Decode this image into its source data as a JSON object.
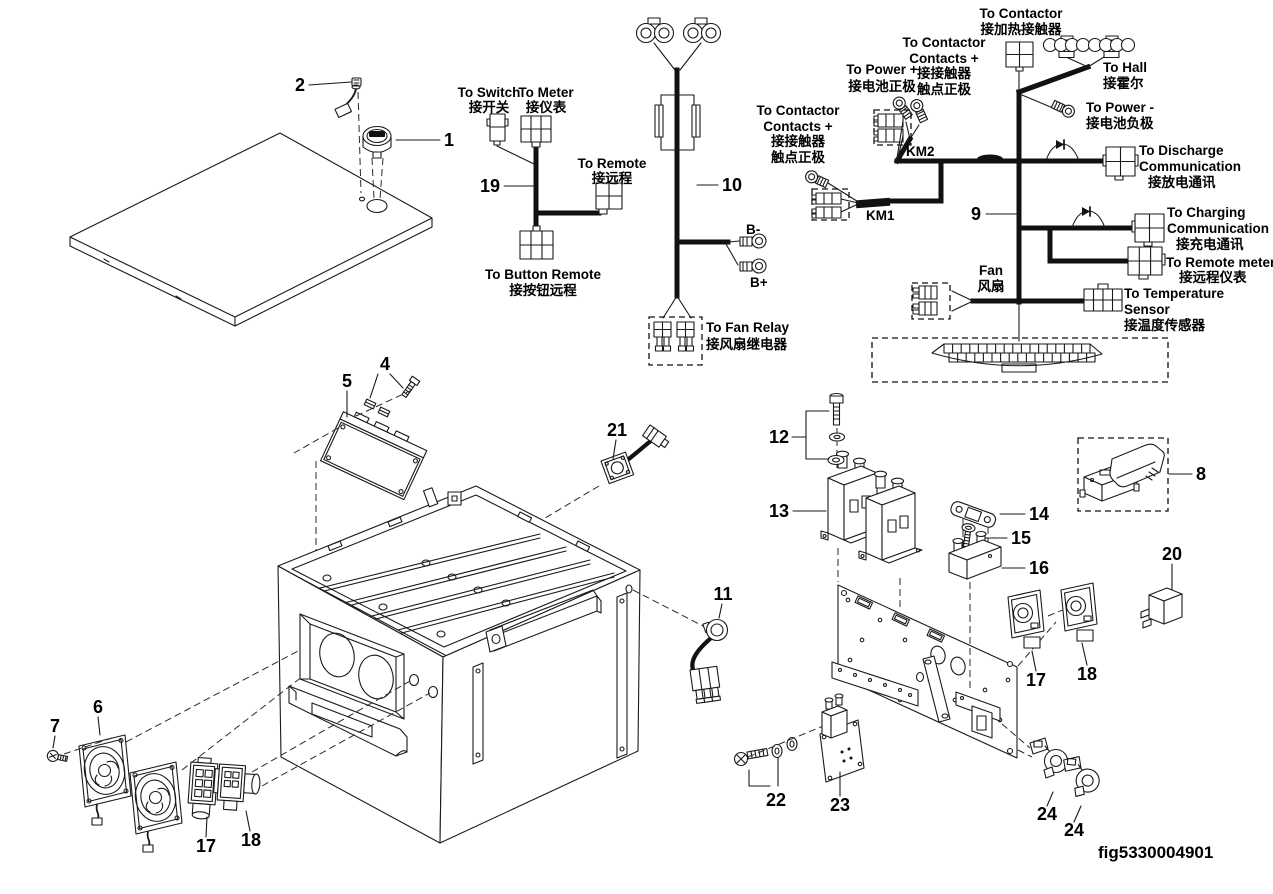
{
  "figure_id": "fig5330004901",
  "callouts": {
    "c1": "1",
    "c2": "2",
    "c4": "4",
    "c5": "5",
    "c6": "6",
    "c7": "7",
    "c8": "8",
    "c9": "9",
    "c10": "10",
    "c11": "11",
    "c12": "12",
    "c13": "13",
    "c14": "14",
    "c15": "15",
    "c16": "16",
    "c17": "17",
    "c18": "18",
    "c19": "19",
    "c20": "20",
    "c21": "21",
    "c22": "22",
    "c23": "23",
    "c24": "24",
    "km1": "KM1",
    "km2": "KM2",
    "b_minus": "B-",
    "b_plus": "B+"
  },
  "labels": {
    "to_switch": {
      "lines": [
        "To Switch",
        "接开关"
      ]
    },
    "to_meter": {
      "lines": [
        "To Meter",
        "接仪表"
      ]
    },
    "to_remote": {
      "lines": [
        "To Remote",
        "接远程"
      ]
    },
    "to_button_remote": {
      "lines": [
        "To Button Remote",
        "接按钮远程"
      ]
    },
    "to_fan_relay": {
      "lines": [
        "To Fan Relay",
        "接风扇继电器"
      ]
    },
    "to_contactor_heat": {
      "lines": [
        "To Contactor",
        "接加热接触器"
      ]
    },
    "to_contactor_contacts_km2": {
      "lines": [
        "To Contactor",
        "Contacts +",
        "接接触器",
        "触点正极"
      ]
    },
    "to_power_plus": {
      "lines": [
        "To Power +",
        "接电池正极"
      ]
    },
    "to_contactor_contacts_km1": {
      "lines": [
        "To Contactor",
        "Contacts +",
        "接接触器",
        "触点正极"
      ]
    },
    "to_hall": {
      "lines": [
        "To Hall",
        "接霍尔"
      ]
    },
    "to_power_minus": {
      "lines": [
        "To Power -",
        "接电池负极"
      ]
    },
    "to_discharge_comm": {
      "lines": [
        "To Discharge",
        "Communication",
        "接放电通讯"
      ]
    },
    "to_charging_comm": {
      "lines": [
        "To Charging",
        "Communication",
        "接充电通讯"
      ]
    },
    "to_remote_meters": {
      "lines": [
        "To Remote meters",
        "接远程仪表"
      ]
    },
    "to_temp_sensor": {
      "lines": [
        "To Temperature",
        "Sensor",
        "接温度传感器"
      ]
    },
    "fan": {
      "lines": [
        "Fan",
        "风扇"
      ]
    }
  }
}
